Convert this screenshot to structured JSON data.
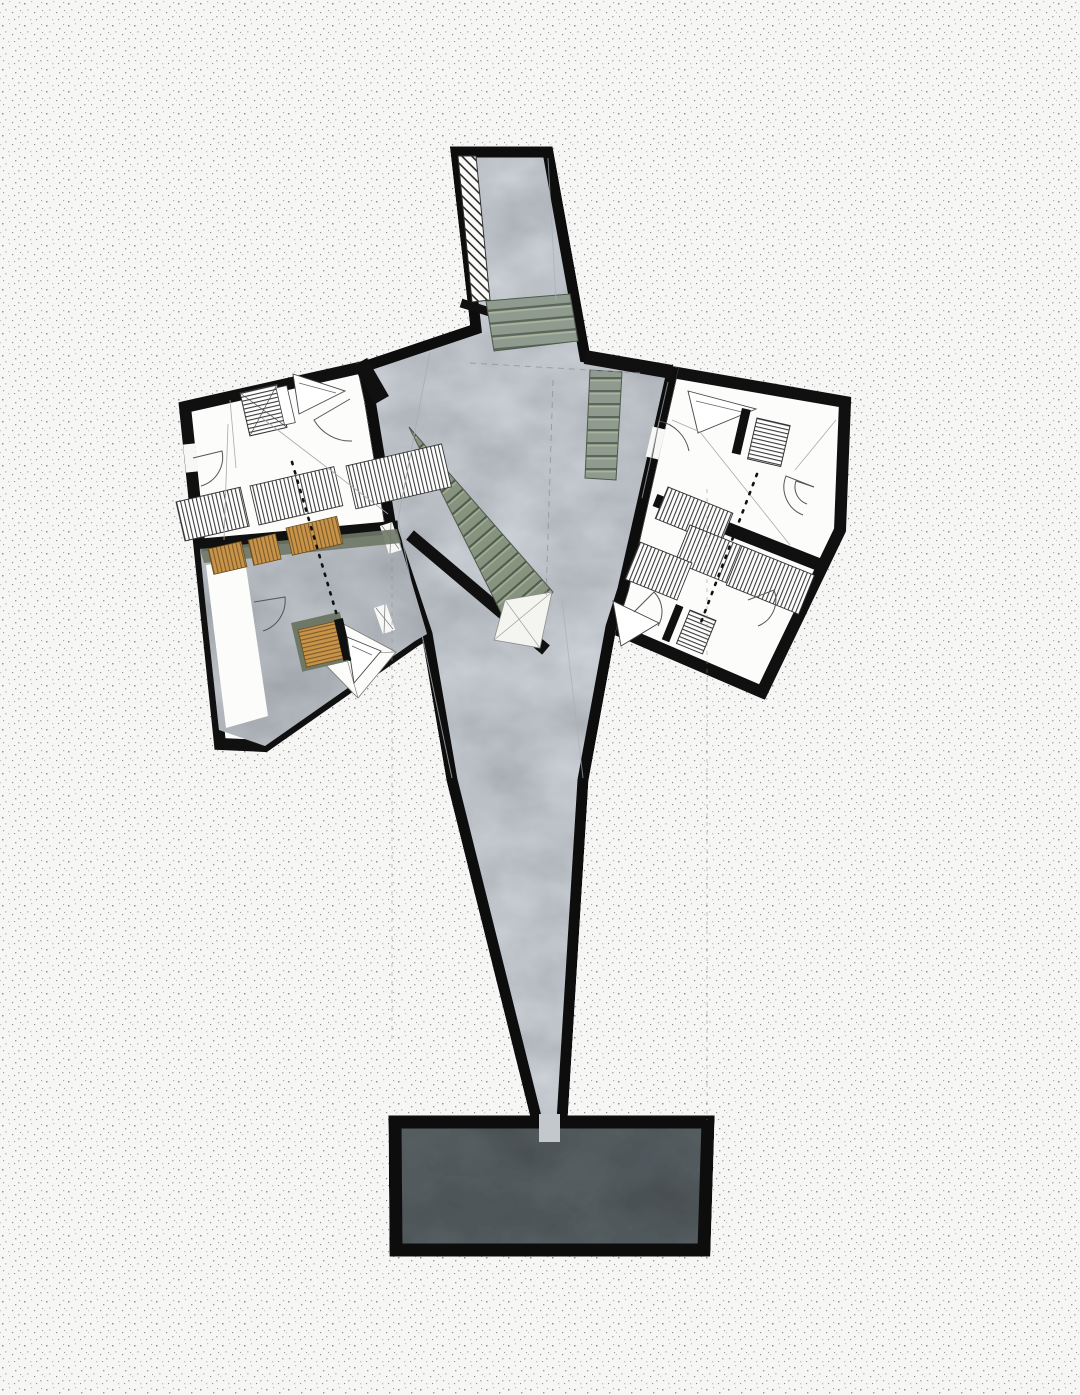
{
  "document": {
    "type": "architectural-floor-plan",
    "description": "axonometric-style floor plan with angular wings on stippled paper",
    "canvas": {
      "width_px": 1080,
      "height_px": 1395
    }
  },
  "palette": {
    "background": "#f6f6f4",
    "stipple_dot": "#8d8d8d",
    "wall": "#101010",
    "concrete": "#ccd1d5",
    "concrete_dark": "#bfc4c8",
    "floor_white": "#fcfcfa",
    "stair_green": "#8f9b8e",
    "stair_shadow": "#5a665a",
    "stair_highlight": "#a9b3a0",
    "wood": "#c8944a",
    "wood_line": "#7d5a28",
    "olive_pad": "#6e7866",
    "slate": "#596163",
    "furniture_line": "#555555",
    "faint_line": "#9aa1a7",
    "hatch_line": "#2a2a2a"
  },
  "inventory": {
    "wings": [
      {
        "name": "left-wing",
        "rooms": 2,
        "wood_benches": 4,
        "striped_radiators": 3,
        "floor_grates": 1,
        "door_arcs": 3
      },
      {
        "name": "right-wing",
        "rooms": 2,
        "wood_benches": 0,
        "striped_radiators": 5,
        "floor_grates": 2,
        "door_arcs": 4
      }
    ],
    "stair_flights": 3,
    "entry_ramp_hatched": 1,
    "terrace_slab": 1,
    "section_dotted_lines": 2,
    "construction_dashed_lines": 2
  }
}
